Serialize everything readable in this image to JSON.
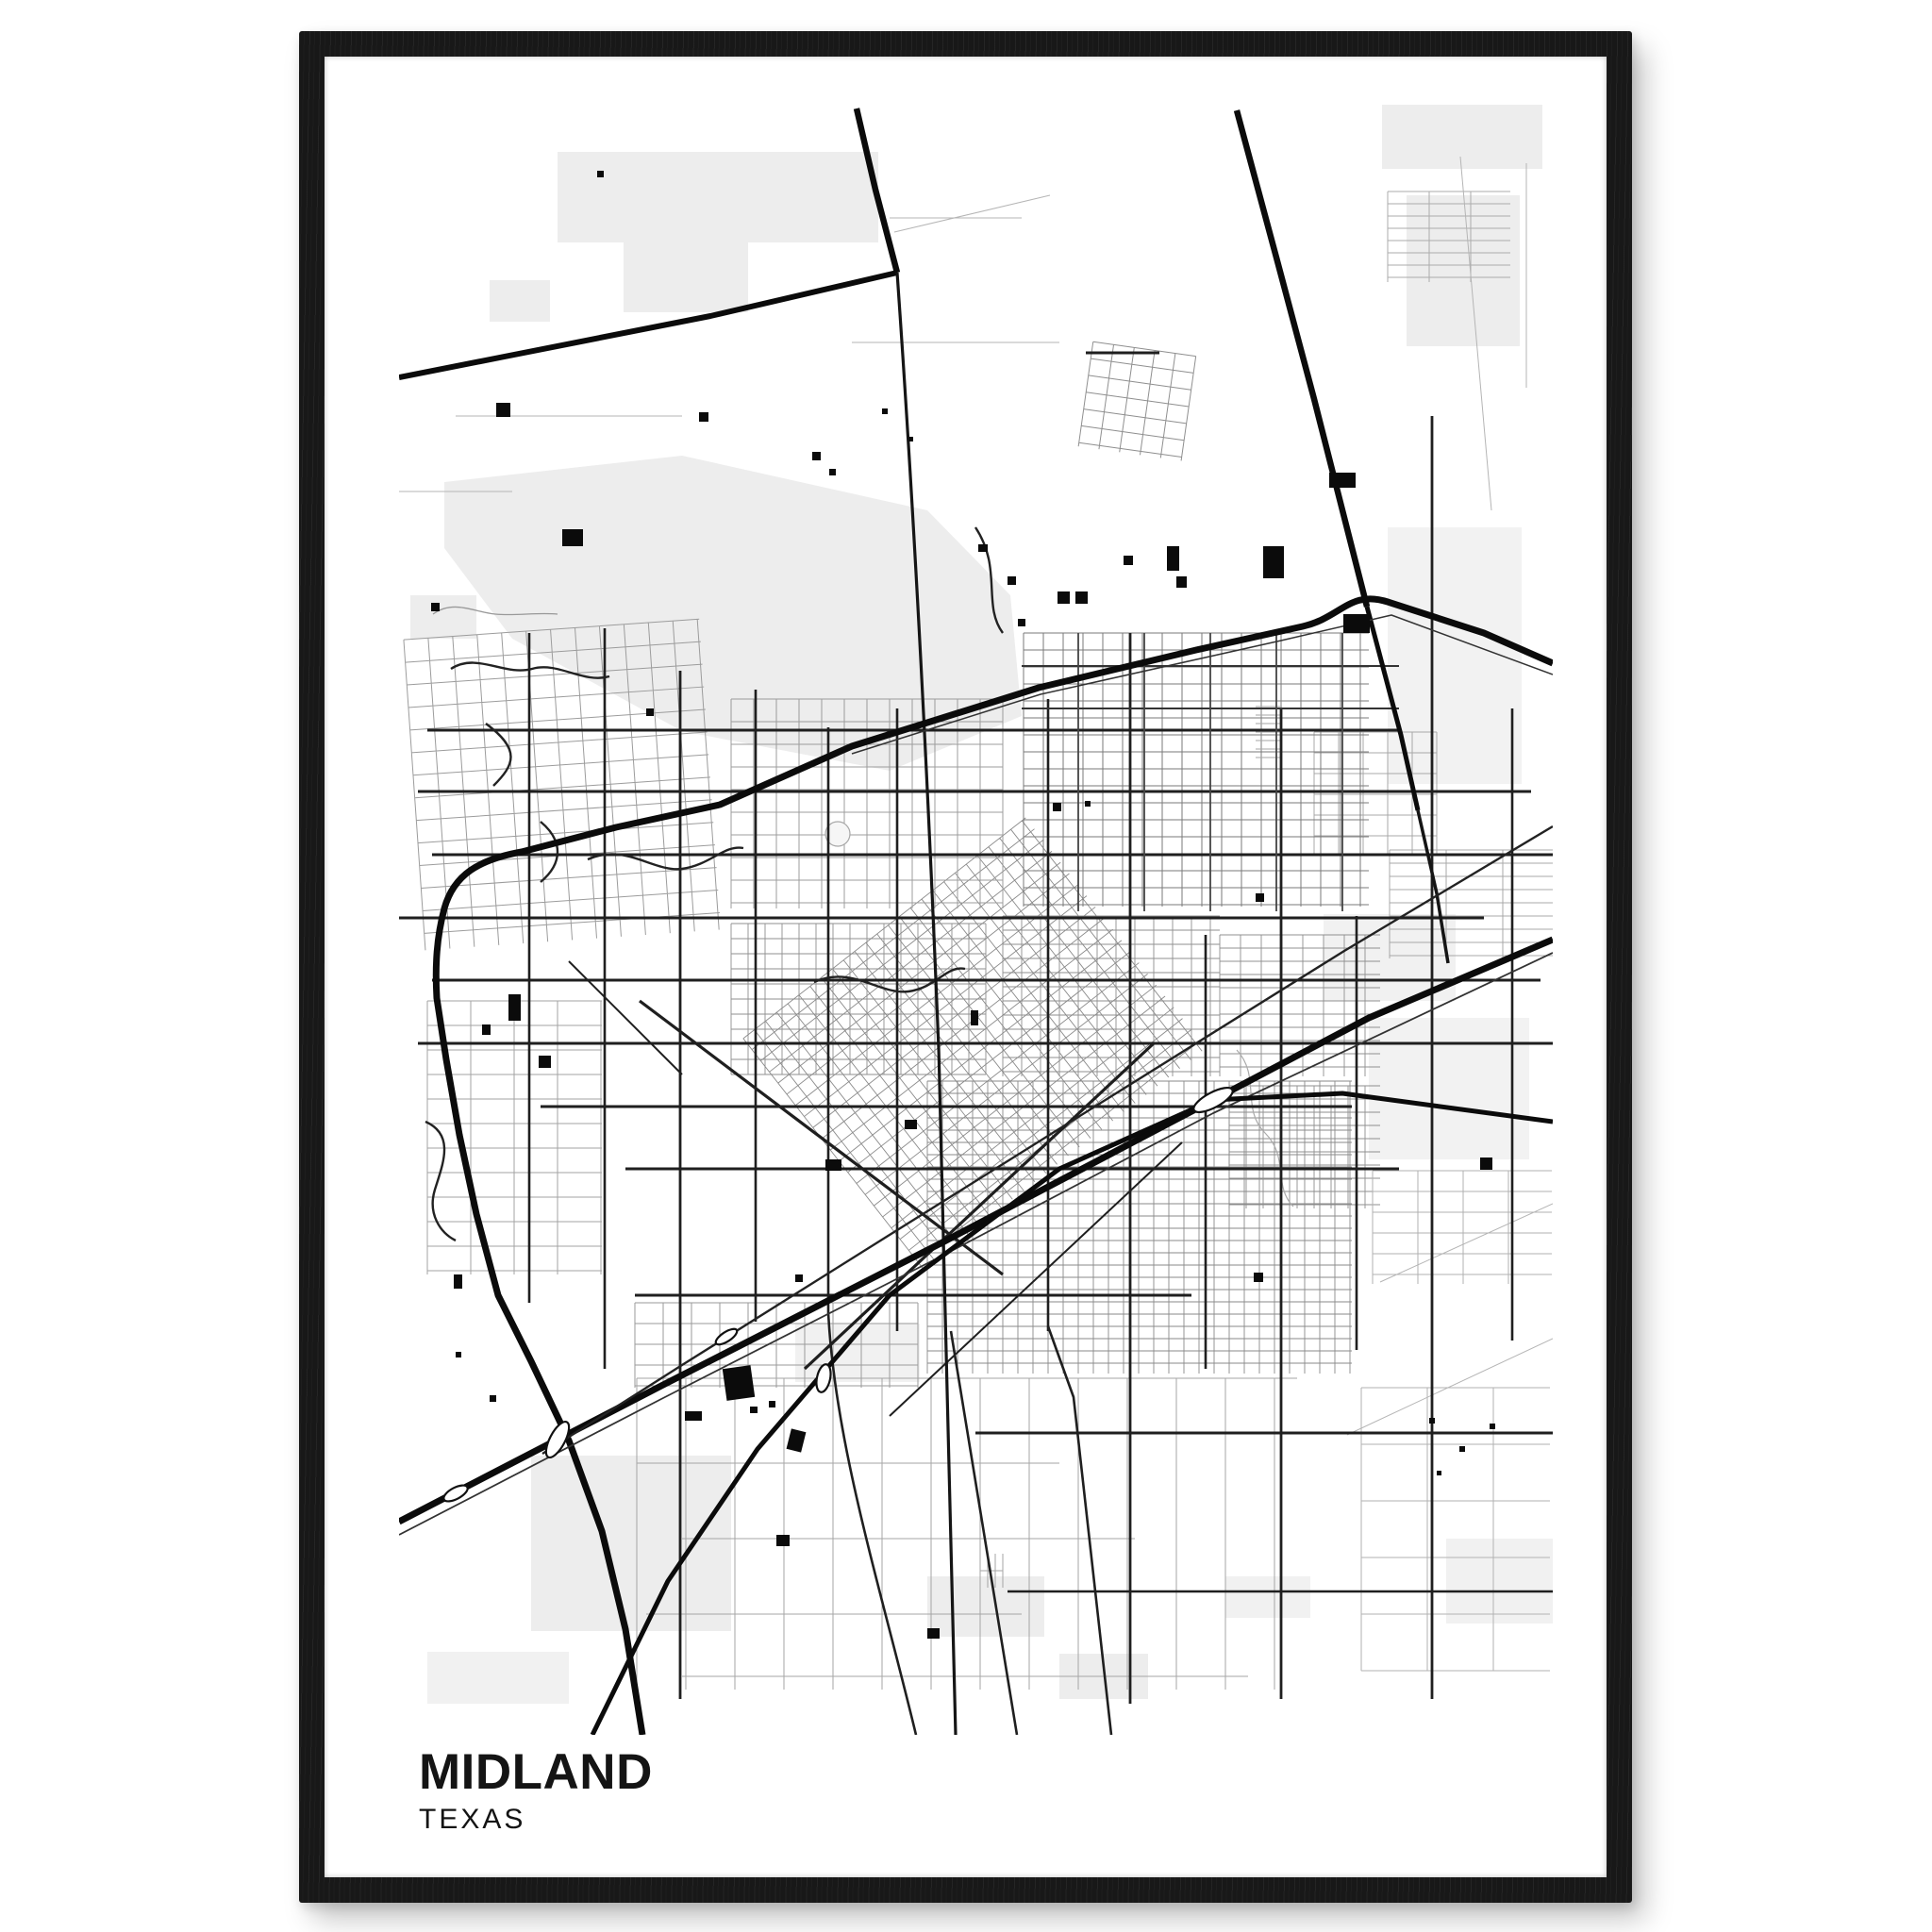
{
  "poster": {
    "title": "MIDLAND",
    "subtitle": "TEXAS"
  },
  "colors": {
    "frame_color": "#181818",
    "poster_color": "#ffffff",
    "title_color": "#141414",
    "road_major": "#0b0b0b",
    "road_medium": "#1f1f1f",
    "road_minor": "#9a9a9a",
    "area_fill": "#ededed"
  }
}
